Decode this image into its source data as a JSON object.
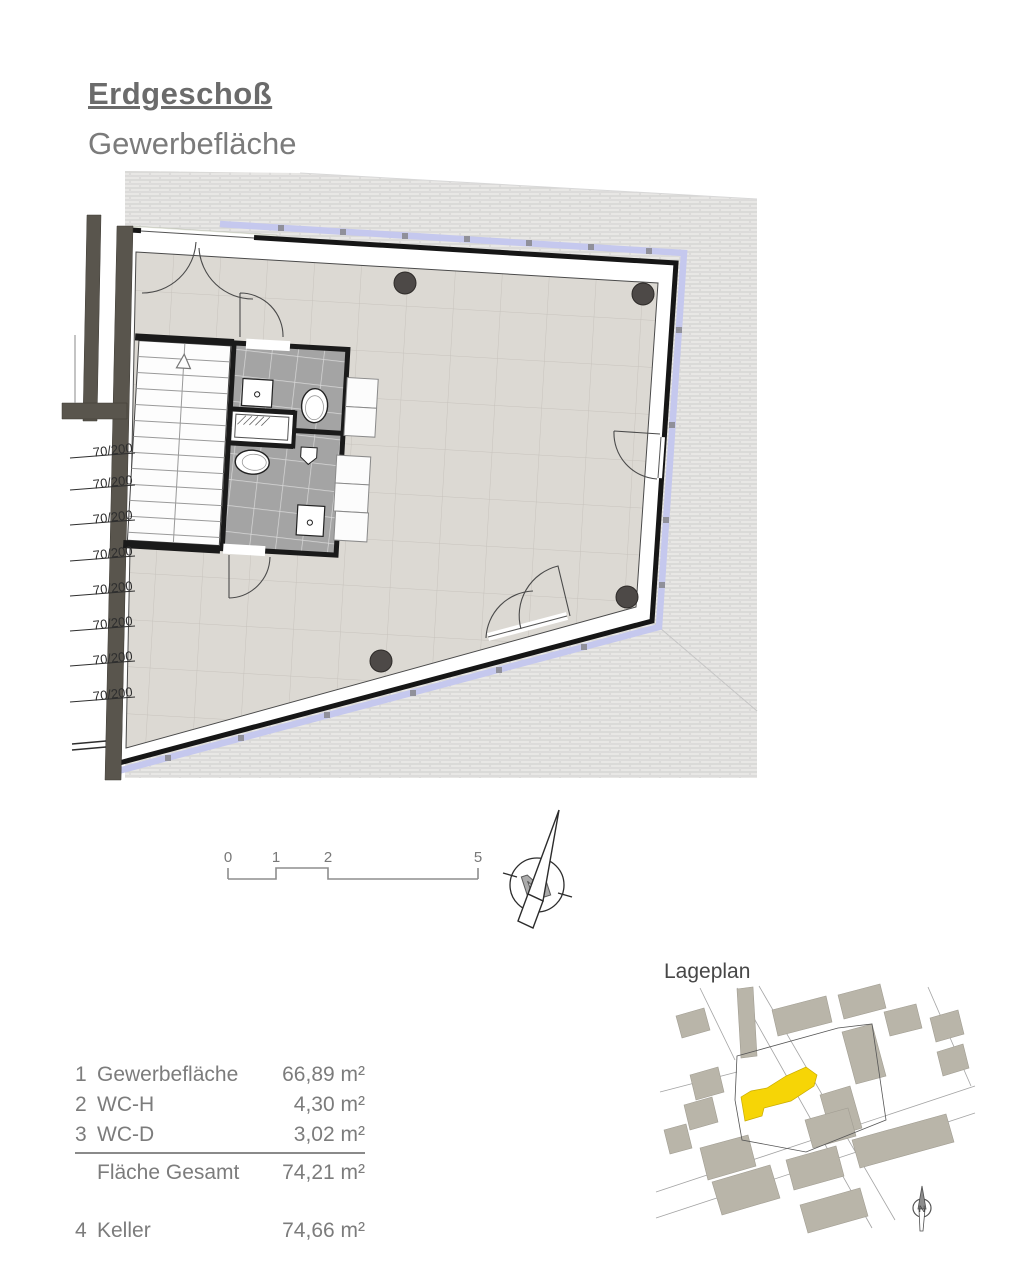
{
  "page": {
    "title": "Erdgeschoß",
    "subtitle": "Gewerbefläche"
  },
  "plan": {
    "door_labels": [
      "70/200",
      "70/200",
      "70/200",
      "70/200",
      "70/200",
      "70/200",
      "70/200",
      "70/200"
    ]
  },
  "scale_bar": {
    "ticks": [
      "0",
      "1",
      "2",
      "5"
    ]
  },
  "compass": {
    "label": "N"
  },
  "lageplan": {
    "title": "Lageplan",
    "north_label": "N"
  },
  "area_table": {
    "rows": [
      {
        "num": "1",
        "label": "Gewerbefläche",
        "value": "66,89 m²"
      },
      {
        "num": "2",
        "label": "WC-H",
        "value": "4,30 m²"
      },
      {
        "num": "3",
        "label": "WC-D",
        "value": "3,02 m²"
      }
    ],
    "total": {
      "label": "Fläche Gesamt",
      "value": "74,21 m²"
    },
    "basement": {
      "num": "4",
      "label": "Keller",
      "value": "74,66 m²"
    }
  },
  "colors": {
    "text_gray": "#7c7c7c",
    "wall_black": "#1a1a1a",
    "wall_taupe": "#59554d",
    "window_band": "#c5c8ee",
    "floor": "#dcd9d3",
    "wc_tile": "#a4a4a4",
    "brick": "#e9e8e6",
    "highlight_yellow": "#f6d506",
    "map_building": "#b9b5a9"
  }
}
